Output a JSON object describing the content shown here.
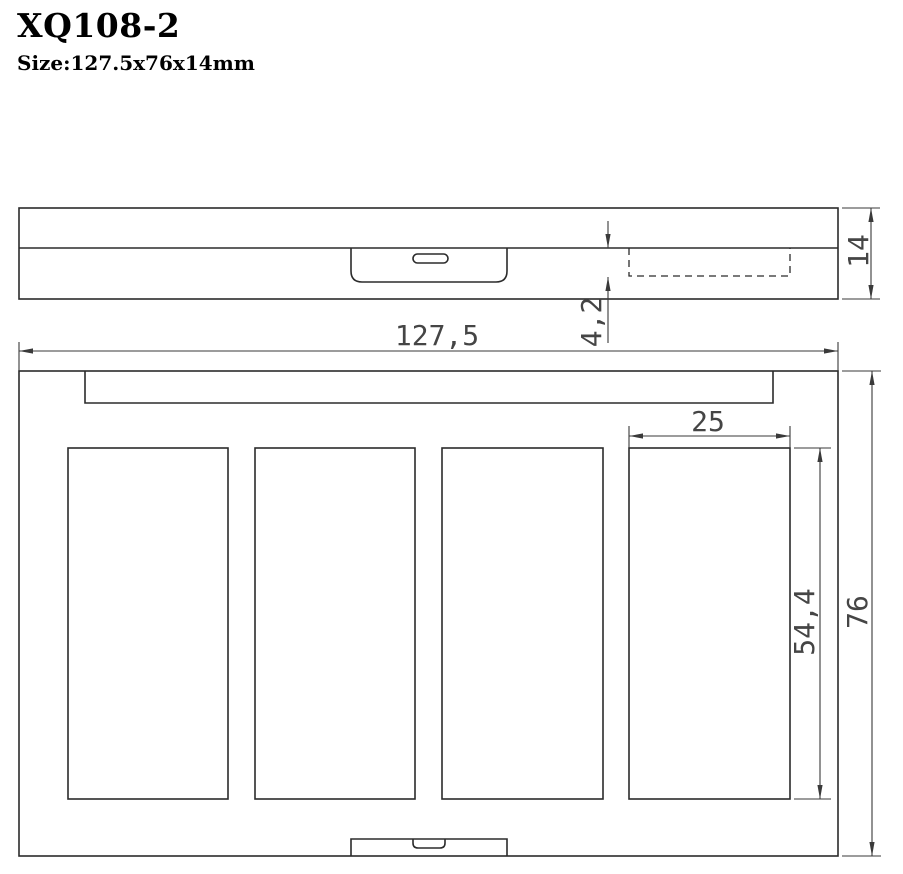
{
  "header": {
    "model": "XQ108-2",
    "size": "Size:127.5x76x14mm"
  },
  "dims": {
    "overall_width": "127,5",
    "overall_depth": "76",
    "thickness": "14",
    "recess_depth": "4,2",
    "pan_width": "25",
    "pan_length": "54,4"
  },
  "drawing": {
    "ink_color": "#2b2b2b",
    "pan_count": 4
  }
}
